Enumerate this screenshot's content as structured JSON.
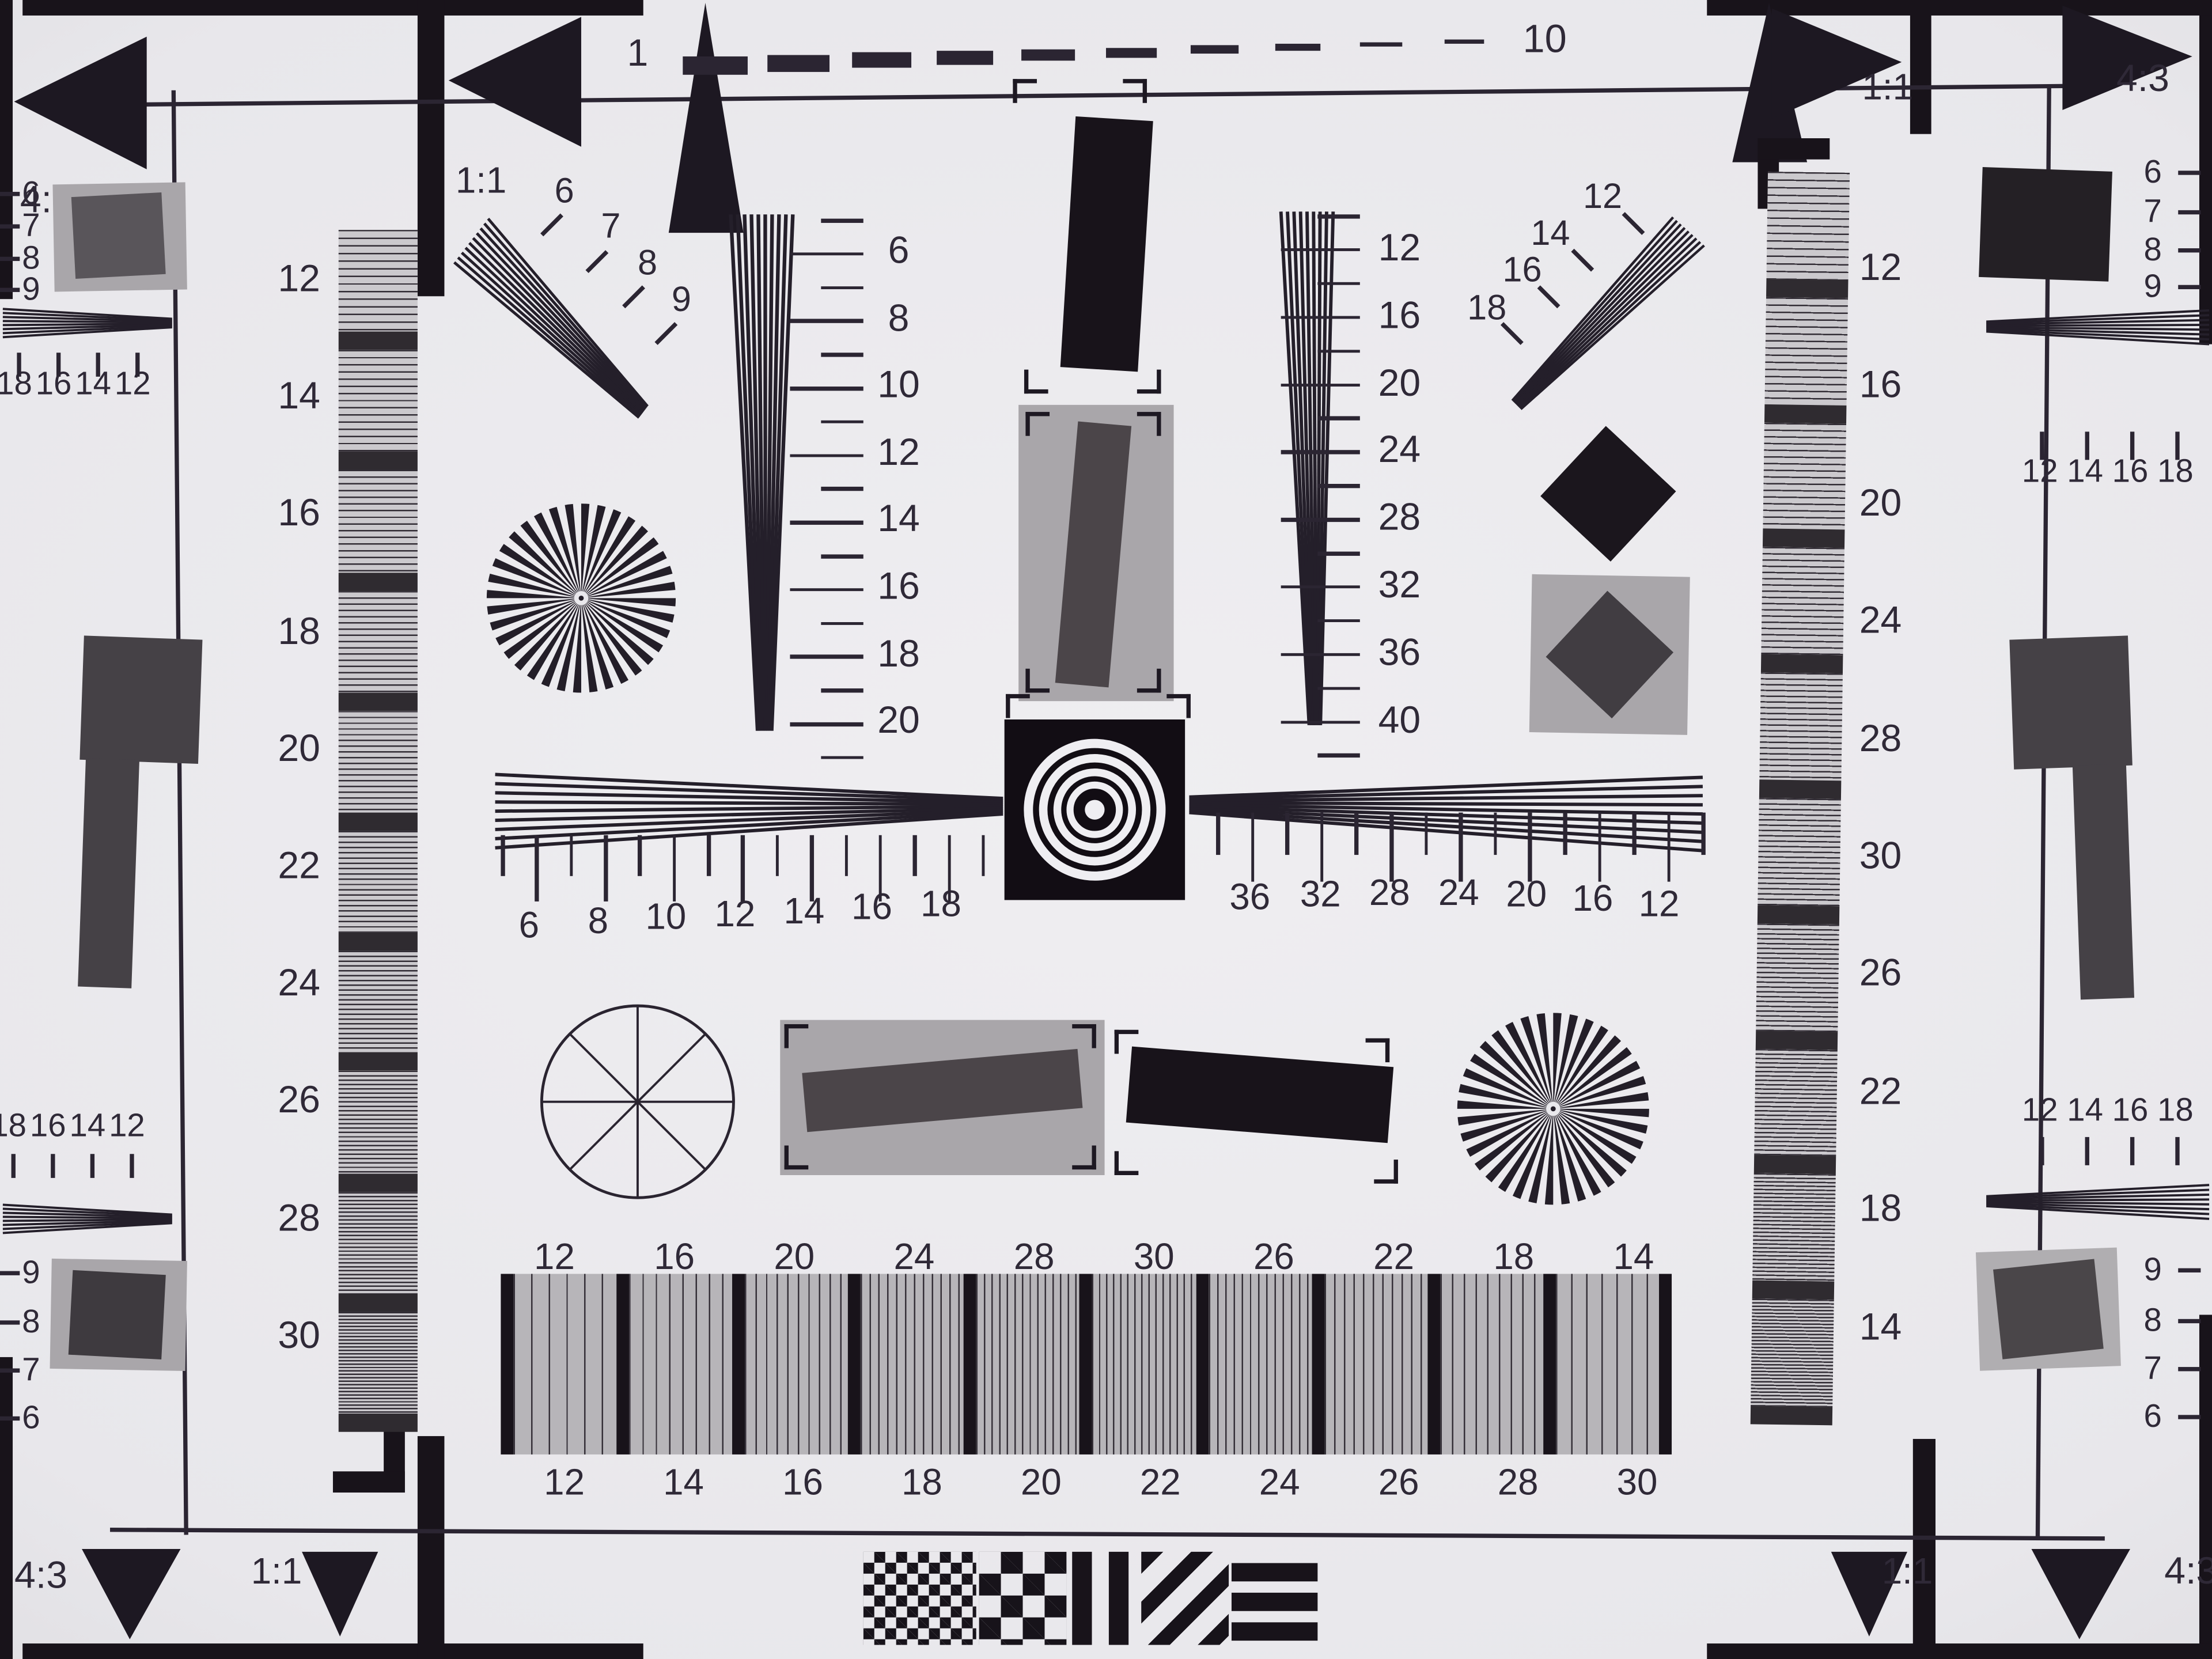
{
  "corners": {
    "top_left_aspect": "4:3",
    "top_left_square": "1:1",
    "top_right_square": "1:1",
    "top_right_aspect": "4:3",
    "bottom_left_aspect": "4:3",
    "bottom_left_square": "1:1",
    "bottom_right_square": "1:1",
    "bottom_right_aspect": "4:3"
  },
  "top_ruler": {
    "start_label": "1",
    "end_label": "10"
  },
  "left_step_wedge": {
    "labels": [
      "12",
      "14",
      "16",
      "18",
      "20",
      "22",
      "24",
      "26",
      "28",
      "30"
    ]
  },
  "right_step_wedge": {
    "labels": [
      "12",
      "16",
      "20",
      "24",
      "28",
      "30",
      "26",
      "22",
      "18",
      "14"
    ]
  },
  "upper_left_fan": {
    "labels": [
      "6",
      "7",
      "8",
      "9"
    ]
  },
  "upper_right_fan": {
    "labels": [
      "12",
      "14",
      "16",
      "18"
    ]
  },
  "left_vertical_scale": {
    "labels": [
      "6",
      "8",
      "10",
      "12",
      "14",
      "16",
      "18",
      "20"
    ]
  },
  "right_vertical_scale": {
    "labels": [
      "12",
      "16",
      "20",
      "24",
      "28",
      "32",
      "36",
      "40"
    ]
  },
  "center_scale": {
    "left_labels": [
      "6",
      "8",
      "10",
      "12",
      "14",
      "16",
      "18"
    ],
    "right_labels": [
      "36",
      "32",
      "28",
      "24",
      "20",
      "16",
      "12"
    ]
  },
  "bottom_row": {
    "top_labels": [
      "12",
      "16",
      "20",
      "24",
      "28",
      "30",
      "26",
      "22",
      "18",
      "14"
    ],
    "bottom_labels": [
      "12",
      "14",
      "16",
      "18",
      "20",
      "22",
      "24",
      "26",
      "28",
      "30"
    ]
  },
  "edges": {
    "left_top": {
      "dash_labels": [
        "6",
        "7",
        "8",
        "9"
      ],
      "tick_labels": [
        "18",
        "16",
        "14",
        "12"
      ]
    },
    "left_bottom": {
      "tick_labels": [
        "18",
        "16",
        "14",
        "12"
      ],
      "dash_labels": [
        "9",
        "8",
        "7",
        "6"
      ]
    },
    "right_top": {
      "dash_labels": [
        "6",
        "7",
        "8",
        "9"
      ],
      "tick_labels": [
        "12",
        "14",
        "16",
        "18"
      ]
    },
    "right_bottom": {
      "tick_labels": [
        "12",
        "14",
        "16",
        "18"
      ],
      "dash_labels": [
        "9",
        "8",
        "7",
        "6"
      ]
    }
  },
  "colors": {
    "ink": "#2f2937",
    "black": "#18131a",
    "gray_patch": "#a9a6aa",
    "dark_patch": "#4b4549",
    "paper": "#efeef1",
    "paper_edge": "#c6c5cb"
  }
}
